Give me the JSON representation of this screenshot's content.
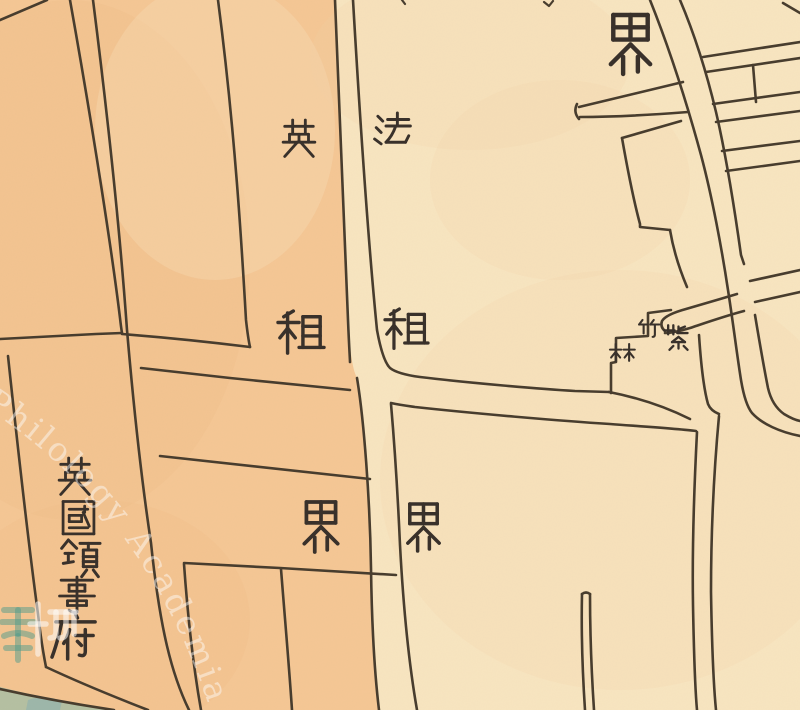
{
  "map": {
    "colors": {
      "paper_cream": "#f8e5c0",
      "concession_orange": "#f5c795",
      "orange_shade": "#efb37d",
      "cream_warm": "#f3cf9e",
      "ink": "#473c2d",
      "glyph_ink": "#38302a",
      "water_green": "#a9bfa4",
      "water_teal": "#93b3ae",
      "watermark_white": "#ffffff",
      "watermark_teal": "#4f9c8b"
    },
    "labels": [
      {
        "id": "english-concession",
        "text": "英租界",
        "meaning": "label read top-to-bottom on orange (west) side of boundary street",
        "chars": [
          {
            "g": "英",
            "x": 280,
            "y": 120,
            "s": 38
          },
          {
            "g": "租",
            "x": 278,
            "y": 311,
            "s": 46
          },
          {
            "g": "界",
            "x": 296,
            "y": 502,
            "s": 50
          }
        ]
      },
      {
        "id": "french-concession",
        "text": "法租界",
        "meaning": "label read top-to-bottom on cream (east) side of boundary street",
        "chars": [
          {
            "g": "法",
            "x": 373,
            "y": 113,
            "s": 39
          },
          {
            "g": "租",
            "x": 385,
            "y": 309,
            "s": 43
          },
          {
            "g": "界",
            "x": 400,
            "y": 504,
            "s": 47
          }
        ]
      },
      {
        "id": "boundary-marker-top",
        "text": "界",
        "meaning": "single boundary character near top right",
        "chars": [
          {
            "g": "界",
            "x": 601,
            "y": 15,
            "s": 59
          }
        ]
      },
      {
        "id": "british-consulate",
        "text": "英國領事府",
        "meaning": "vertical column label at lower left",
        "chars": [
          {
            "g": "英",
            "x": 56,
            "y": 458,
            "s": 38
          },
          {
            "g": "國",
            "x": 60,
            "y": 500,
            "s": 37
          },
          {
            "g": "領",
            "x": 60,
            "y": 540,
            "s": 40
          },
          {
            "g": "事",
            "x": 58,
            "y": 577,
            "s": 38
          },
          {
            "g": "府",
            "x": 52,
            "y": 614,
            "s": 47
          }
        ]
      },
      {
        "id": "zizhulin",
        "text": "紫竹林",
        "meaning": "small label written right-to-left beside stepped block",
        "chars": [
          {
            "g": "紫",
            "x": 663,
            "y": 324,
            "s": 31
          },
          {
            "g": "竹",
            "x": 638,
            "y": 320,
            "s": 27
          },
          {
            "g": "林",
            "x": 610,
            "y": 344,
            "s": 27
          }
        ]
      }
    ],
    "watermark": {
      "arc_text": "Philology Academia Sinica I"
    }
  }
}
